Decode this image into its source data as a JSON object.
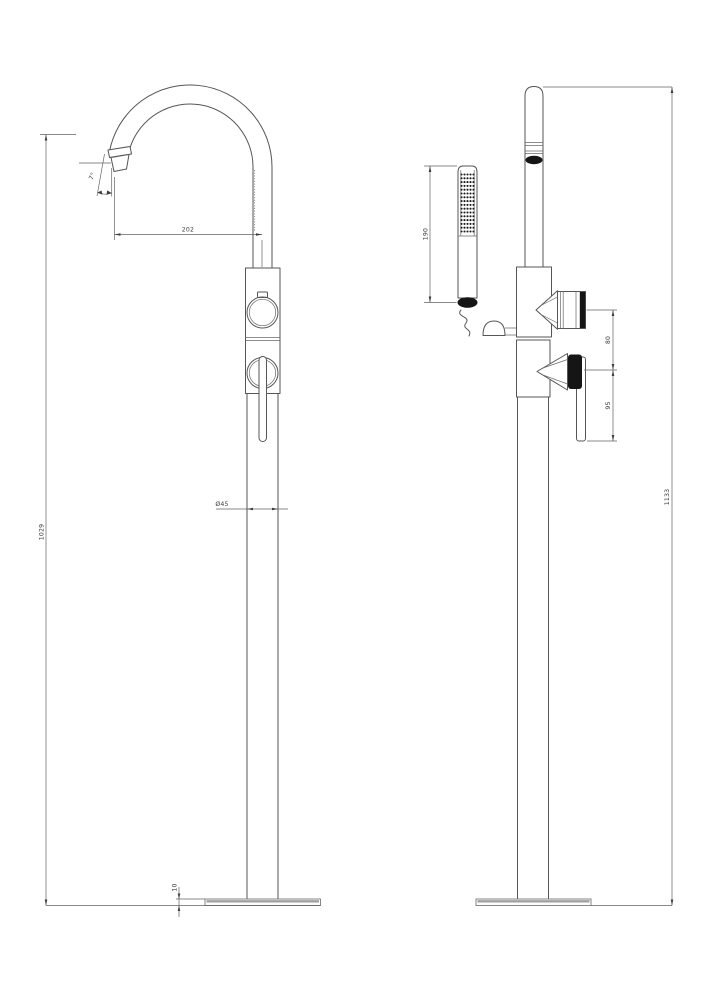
{
  "drawing": {
    "kind": "two-view dimensioned technical drawing",
    "views": {
      "left": "front-view",
      "right": "side-view"
    },
    "colors": {
      "background": "#ffffff",
      "line": "#565656",
      "dimension_line": "#636363",
      "text": "#3a3a3a",
      "dark_fill": "#151515"
    },
    "dims": {
      "spout_reach": "202",
      "spout_angle": "7°",
      "spout_height": "1029",
      "column_diameter": "Ø45",
      "base_thickness": "10",
      "handshower_length": "190",
      "outlet_to_lever": "80",
      "lever_length": "95",
      "overall_height": "1133"
    }
  }
}
